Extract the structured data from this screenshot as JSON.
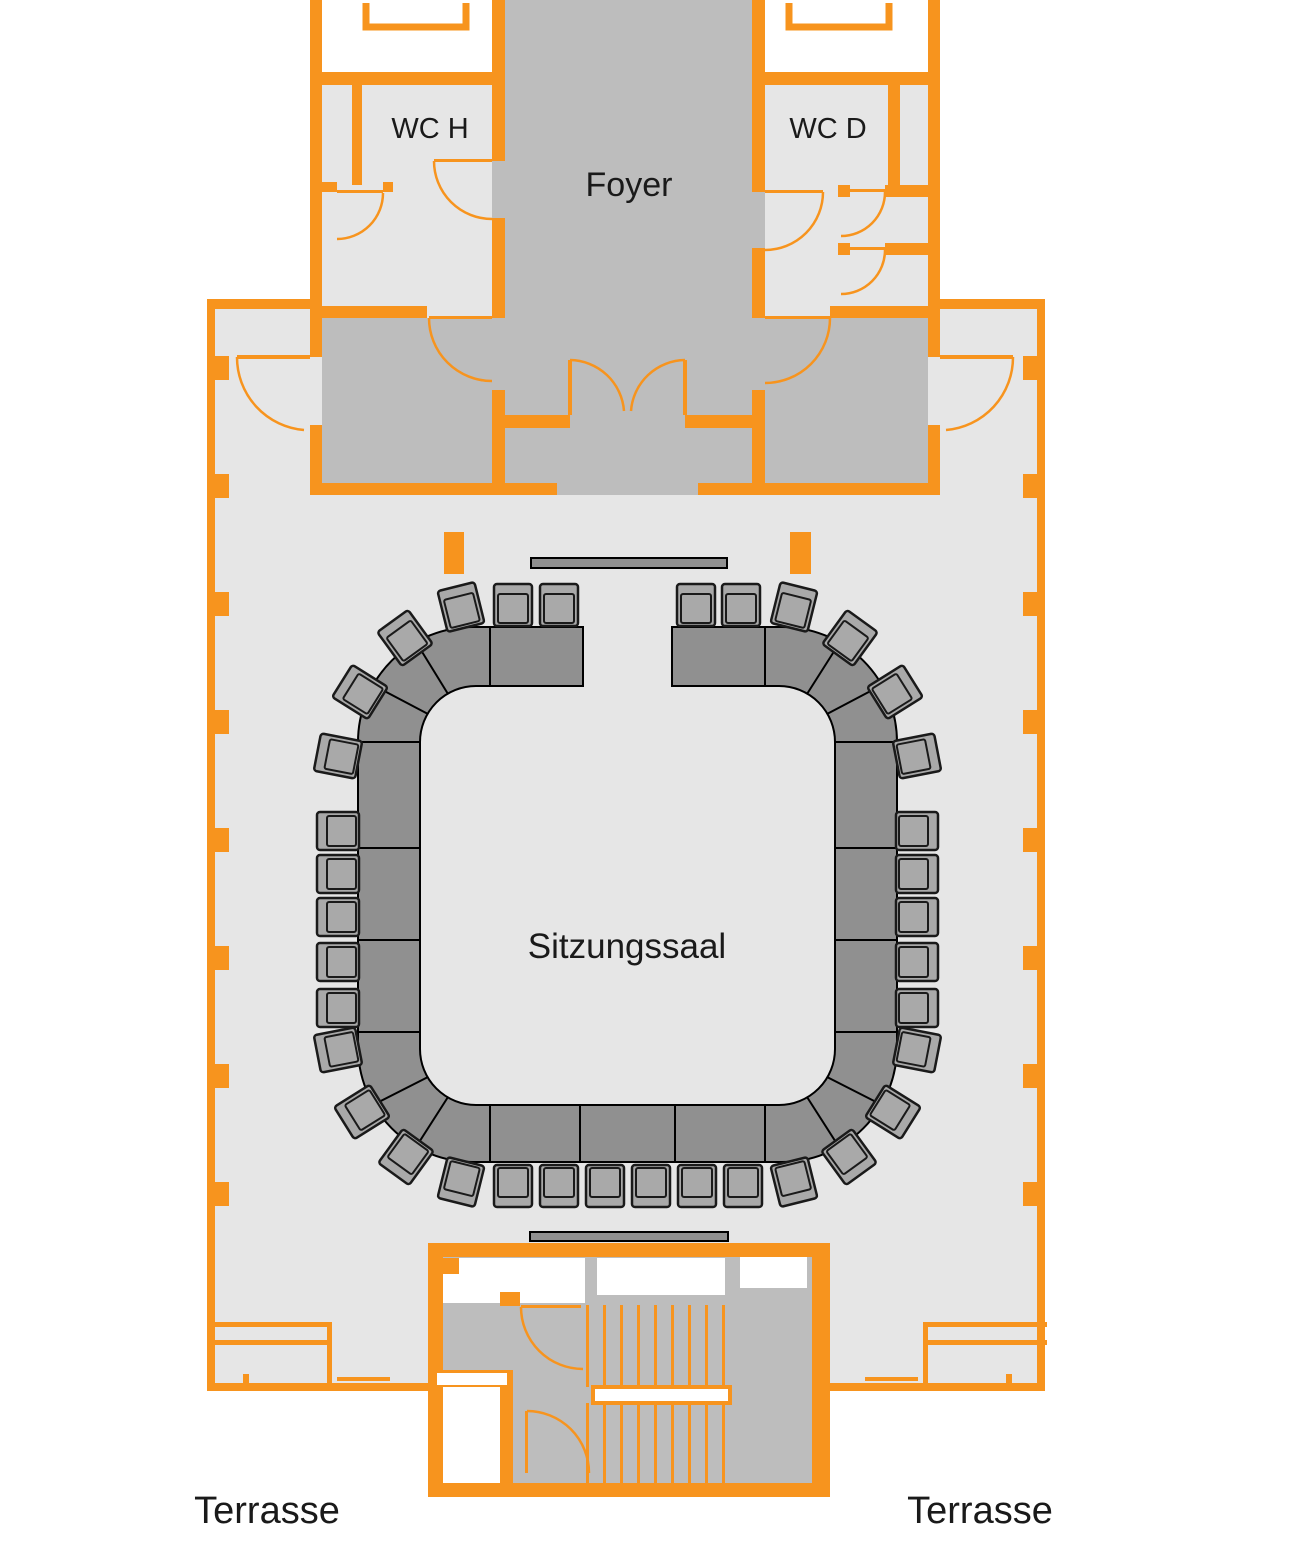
{
  "plan": {
    "type": "floor-plan",
    "language": "de"
  },
  "labels": {
    "foyer": "Foyer",
    "wc_h": "WC H",
    "wc_d": "WC D",
    "sitzungssaal": "Sitzungssaal",
    "terrasse_left": "Terrasse",
    "terrasse_right": "Terrasse"
  },
  "colors": {
    "wall_orange": "#F7941E",
    "hall_floor": "#E6E6E6",
    "circulation_gray": "#BDBDBD",
    "table_gray": "#909090",
    "chair_gray": "#A9A9A9",
    "outline_black": "#000000",
    "text": "#1A1A1A",
    "exterior_white": "#FFFFFF"
  }
}
